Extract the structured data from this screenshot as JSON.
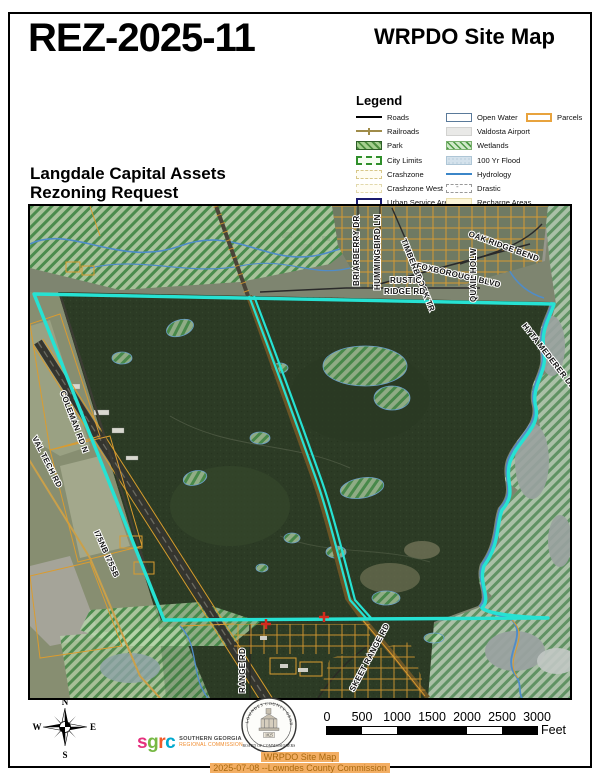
{
  "header": {
    "case_number": "REZ-2025-11",
    "map_title": "WRPDO Site Map",
    "request_line1": "Langdale Capital Assets",
    "request_line2": "Rezoning Request"
  },
  "legend": {
    "title": "Legend",
    "col1": [
      "Roads",
      "Railroads",
      "Park",
      "City Limits",
      "Crashzone",
      "Crashzone West",
      "Urban Service Area"
    ],
    "col2": [
      "Open Water",
      "Valdosta Airport",
      "Wetlands",
      "100 Yr Flood",
      "Hydrology",
      "Drastic",
      "Recharge Areas"
    ],
    "col3": [
      "Parcels"
    ]
  },
  "map": {
    "labels": {
      "coleman": "COLEMAN RD N",
      "valtech": "VAL TECH RD",
      "i75": "I75NB  I75SB",
      "range": "RANGE RD",
      "skeet": "SKEET RANGE RD",
      "briarberry": "BRIARBERRY DR",
      "hummingbird": "HUMMINGBIRD LN",
      "timberbrook": "TIMBERBROOK TR",
      "foxborough": "FOXBOROUGH BLVD",
      "oakridge": "OAK RIDGE BEND",
      "rustic_line1": "RUSTIC",
      "rustic_line2": "RIDGE RD",
      "quail": "QUAIL HOLW",
      "hyta": "HYTA MEDERER DR"
    }
  },
  "compass": {
    "n": "N",
    "e": "E",
    "s": "S",
    "w": "W"
  },
  "logos": {
    "sgrc": {
      "letters": [
        "s",
        "g",
        "r",
        "c"
      ],
      "letter_colors": [
        "#e5317f",
        "#76b843",
        "#f15a29",
        "#00a9ce"
      ],
      "org_line1": "SOUTHERN GEORGIA",
      "org_line2": "REGIONAL COMMISSION"
    },
    "seal": {
      "arc_top": "LOWNDES COUNTY GEORGIA",
      "arc_bottom": "BOARD OF COMMISSIONERS",
      "year": "1825"
    }
  },
  "scale_bar": {
    "ticks": [
      "0",
      "500",
      "1000",
      "1500",
      "2000",
      "2500",
      "3000"
    ],
    "unit": "Feet"
  },
  "footer": {
    "line1": "WRPDO Site Map",
    "line2": "2025-07-08 --Lowndes County Commission"
  },
  "colors": {
    "parcel_boundary_cyan": "#26e2d3",
    "parcel_lines_orange": "#da9c30",
    "hydrology_blue": "#4f8cc9",
    "footer_highlight": "#f3ae63",
    "footer_text": "#a8690f",
    "urban_service_area_navy": "#1a1a6e"
  }
}
